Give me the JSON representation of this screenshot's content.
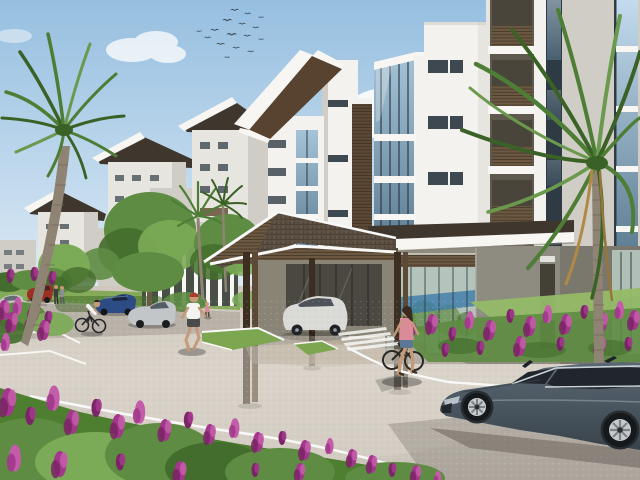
{
  "meta": {
    "width": 640,
    "height": 480
  },
  "scene": {
    "description": "3D architectural rendering of a modern tropical apartment complex: white low-rise towers with swooping dark roofs and wood-slat balconies, a gabled entrance porte-cochere with a white SUV, ground-floor glazing, palm trees, magenta flower beds, curved driveway with white curbs, parked cars, a slate-gray coupe in the foreground, a cyclist, a jogger and a walking woman, and a flock of birds in a blue sky",
    "counts": {
      "birds": 16,
      "visible_floors_main_building": 5,
      "parked_cars": 5,
      "people": 7
    },
    "objects": [
      {
        "name": "sky",
        "label": "Blue daytime sky"
      },
      {
        "name": "birds-flock",
        "label": "Flock of birds"
      },
      {
        "name": "clouds",
        "label": "White clouds"
      },
      {
        "name": "background-towers",
        "label": "Receding apartment towers with swooping roofs"
      },
      {
        "name": "main-building",
        "label": "Main apartment building"
      },
      {
        "name": "corner-glass-bay",
        "label": "Corner glass bay windows"
      },
      {
        "name": "balcony-stack",
        "label": "Recessed balconies with wood-slat railings"
      },
      {
        "name": "entrance-canopy",
        "label": "Gabled shingle entrance porte-cochere"
      },
      {
        "name": "entrance-suv",
        "label": "White SUV parked under entrance canopy"
      },
      {
        "name": "ground-floor-glazing",
        "label": "Ground floor glass curtain wall with blue reflection"
      },
      {
        "name": "left-palm-tree",
        "label": "Tall palm tree, left"
      },
      {
        "name": "right-palm-tree",
        "label": "Tall palm tree, right"
      },
      {
        "name": "deciduous-trees",
        "label": "Green courtyard trees"
      },
      {
        "name": "driveway",
        "label": "Curved paved driveway"
      },
      {
        "name": "parked-cars",
        "label": "Parked cars: red, blue, silver, light silver"
      },
      {
        "name": "cyclist",
        "label": "Cyclist on the drive"
      },
      {
        "name": "jogger",
        "label": "Jogger with red cap"
      },
      {
        "name": "woman-with-bicycle",
        "label": "Woman in pink top walking a bicycle"
      },
      {
        "name": "foreground-sedan",
        "label": "Slate-gray coupe in foreground"
      },
      {
        "name": "flower-beds",
        "label": "Magenta flower beds with green shrubs"
      },
      {
        "name": "pedestrians-pair",
        "label": "Two people standing near parked cars"
      },
      {
        "name": "grass-islands",
        "label": "Grass islands with white curbs"
      },
      {
        "name": "entrance-palms",
        "label": "Small palms at entrance"
      },
      {
        "name": "child-figure",
        "label": "Small figure near entrance column"
      }
    ]
  },
  "colors": {
    "sky_top": "#96bfe0",
    "sky_mid": "#c4dbee",
    "sky_low": "#ecf4f9",
    "cloud": "#fdfdfd",
    "wall_white": "#f3f2ee",
    "wall_light": "#e7e5df",
    "wall_shade": "#cfcdc5",
    "wall_dark": "#b5b3ab",
    "fascia": "#f7f6f2",
    "wall_taupe": "#8e8b81",
    "wall_taupe_dark": "#7a776d",
    "roof_dark": "#3f372e",
    "roof_shingle": "#5c5043",
    "roof_soffit": "#57432f",
    "wood": "#5c4a36",
    "wood_dark": "#3c2f22",
    "wood_slat": "#6d5942",
    "glass_blue": "#a6c4d8",
    "glass_blue_dark": "#5f7f94",
    "glass_frame": "#2e3b45",
    "glass_dark": "#3d4850",
    "glass_teal": "#b4c4ba",
    "pool_blue": "#3c7cab",
    "tree_green": "#5e8c42",
    "tree_light": "#7cab58",
    "tree_dark": "#436d2c",
    "palm_green": "#4e7d35",
    "palm_dark": "#3a6227",
    "palm_light": "#6b9a4e",
    "trunk": "#8f8374",
    "trunk_dark": "#6b6052",
    "grass": "#7ca64f",
    "grass_light": "#95bb67",
    "road_far": "#cfc8bd",
    "road": "#c8c2b8",
    "road_light": "#d9d3c9",
    "road_shade": "#a8a298",
    "road_warm": "#c0a98d",
    "curb": "#f8f8f6",
    "flower": "#a2378c",
    "flower_dark": "#7a2565",
    "flower_light": "#c45ca9",
    "foliage": "#4e7f31",
    "car_body": "#5a6873",
    "car_body_dark": "#39434c",
    "car_window": "#20262c",
    "car_chrome": "#ccd3d8",
    "wheel_silver": "#c6cacd",
    "suv_body": "#dadbd7",
    "car_red": "#9c2e24",
    "car_blue": "#2d4c86",
    "car_silver": "#c3c6c8",
    "bird": "#3c4c58",
    "skin": "#c49a79",
    "shirt_white": "#f4f4f2",
    "cap_red": "#b23a2c",
    "top_pink": "#d98b97",
    "denim": "#5d7797",
    "shadow": "#6b655c"
  }
}
